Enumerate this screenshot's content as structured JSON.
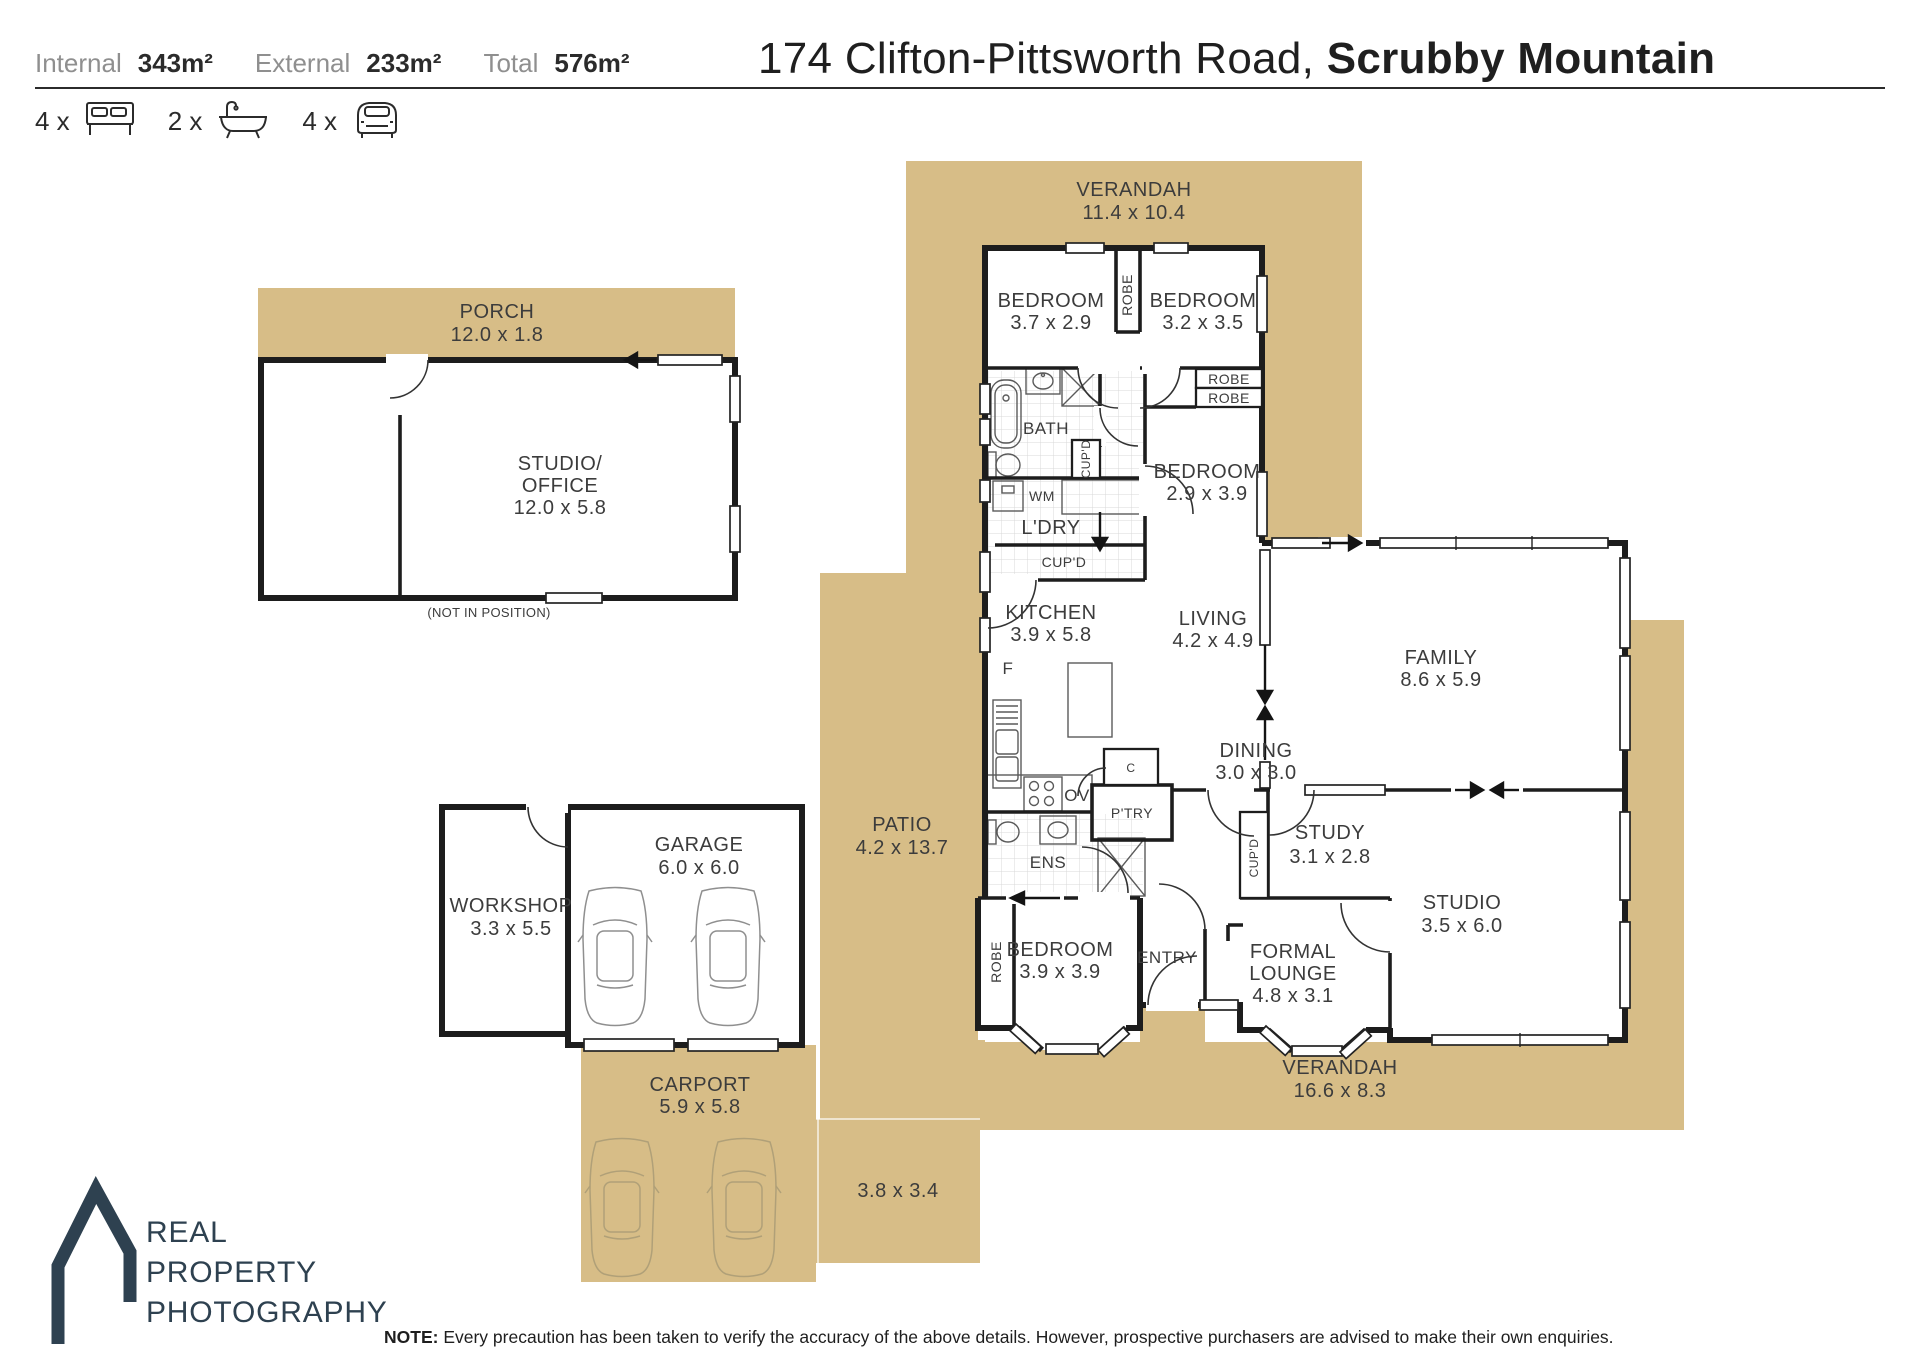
{
  "header": {
    "stats": [
      {
        "label": "Internal",
        "value": "343m²"
      },
      {
        "label": "External",
        "value": "233m²"
      },
      {
        "label": "Total",
        "value": "576m²"
      }
    ],
    "bed_count": "4 x",
    "bath_count": "2 x",
    "car_count": "4 x",
    "title_regular": "174 Clifton-Pittsworth Road, ",
    "title_bold": "Scrubby Mountain"
  },
  "rooms": {
    "verandah_top": {
      "name": "VERANDAH",
      "dims": "11.4 x 10.4"
    },
    "porch": {
      "name": "PORCH",
      "dims": "12.0 x 1.8"
    },
    "studio_office": {
      "name_line1": "STUDIO/",
      "name_line2": "OFFICE",
      "dims": "12.0 x 5.8",
      "note": "(NOT IN POSITION)"
    },
    "bedroom_1": {
      "name": "BEDROOM",
      "dims": "3.7 x 2.9"
    },
    "bedroom_2": {
      "name": "BEDROOM",
      "dims": "3.2 x 3.5"
    },
    "bedroom_3": {
      "name": "BEDROOM",
      "dims": "2.9 x 3.9"
    },
    "bedroom_4": {
      "name": "BEDROOM",
      "dims": "3.9 x 3.9"
    },
    "bath": {
      "name": "BATH"
    },
    "laundry": {
      "name": "L'DRY"
    },
    "ensuite": {
      "name": "ENS"
    },
    "kitchen": {
      "name": "KITCHEN",
      "dims": "3.9 x 5.8"
    },
    "living": {
      "name": "LIVING",
      "dims": "4.2 x 4.9"
    },
    "dining": {
      "name": "DINING",
      "dims": "3.0 x 3.0"
    },
    "family": {
      "name": "FAMILY",
      "dims": "8.6 x 5.9"
    },
    "study": {
      "name": "STUDY",
      "dims": "3.1 x 2.8"
    },
    "studio": {
      "name": "STUDIO",
      "dims": "3.5 x 6.0"
    },
    "formal_lounge": {
      "name_line1": "FORMAL",
      "name_line2": "LOUNGE",
      "dims": "4.8 x 3.1"
    },
    "entry": {
      "name": "ENTRY"
    },
    "patio": {
      "name": "PATIO",
      "dims": "4.2 x 13.7"
    },
    "patio_ext": {
      "dims": "3.8 x 3.4"
    },
    "garage": {
      "name": "GARAGE",
      "dims": "6.0 x 6.0"
    },
    "workshop": {
      "name": "WORKSHOP",
      "dims": "3.3 x 5.5"
    },
    "carport": {
      "name": "CARPORT",
      "dims": "5.9 x 5.8"
    },
    "verandah_bottom": {
      "name": "VERANDAH",
      "dims": "16.6 x 8.3"
    }
  },
  "fixtures": {
    "robe": "ROBE",
    "cupboard": "CUP'D",
    "washing_machine": "WM",
    "pantry": "P'TRY",
    "oven": "OV",
    "closet": "C",
    "fridge": "F"
  },
  "footer": {
    "logo_line1": "REAL",
    "logo_line2": "PROPERTY",
    "logo_line3": "PHOTOGRAPHY",
    "note_label": "NOTE:",
    "note_text": "Every precaution has been taken to verify the accuracy of the above details. However, prospective purchasers are advised to make their own enquiries."
  },
  "colors": {
    "outdoor_tan": "#d7bd87",
    "wall": "#1d1d1d",
    "label_text": "#3c3c3c",
    "logo": "#2e4150"
  }
}
